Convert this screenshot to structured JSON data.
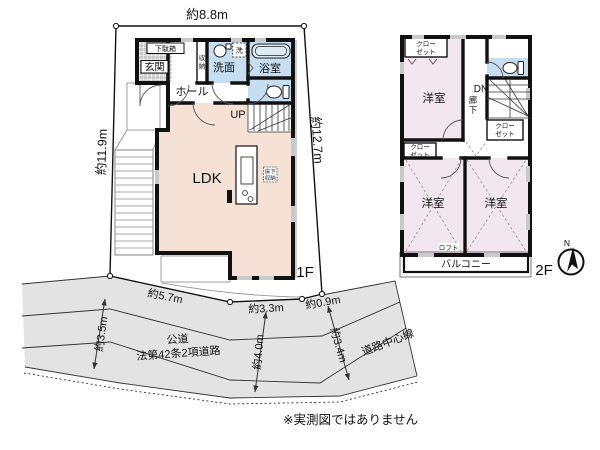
{
  "disclaimer": "※実測図ではありません",
  "compass": {
    "north": "N"
  },
  "colors": {
    "room_warm": "#f6e1d6",
    "room_wet": "#c6def0",
    "room_2f": "#f2e7ee",
    "road": "#e3e3e3",
    "wall": "#111111"
  },
  "dimensions": {
    "top": "約8.8m",
    "left": "約11.9m",
    "right": "約12.7m",
    "bottom1": "約5.7m",
    "bottom2": "約3.3m",
    "bottom3": "約0.9m",
    "road_width_left": "約3.5m",
    "road_width_mid": "約4.0m",
    "road_width_right": "約3.4m"
  },
  "road": {
    "name_line1": "公道",
    "name_line2": "法第42条2項道路",
    "centerline": "道路中心線"
  },
  "floor1": {
    "label": "1F",
    "shoe_cabinet": "下駄箱",
    "entrance": "玄関",
    "storage_char1": "収",
    "storage_char2": "納",
    "washroom": "洗面",
    "washer": "洗",
    "bathroom": "浴室",
    "hall": "ホール",
    "stairs_up": "UP",
    "ldk": "LDK",
    "floor_storage_line1": "床下",
    "floor_storage_line2": "収納"
  },
  "floor2": {
    "label": "2F",
    "closet_line1": "クロー",
    "closet_line2": "ゼット",
    "stairs_down": "DN",
    "corridor_char1": "廊",
    "corridor_char2": "下",
    "western_room": "洋室",
    "loft": "ロフト",
    "balcony": "バルコニー"
  }
}
